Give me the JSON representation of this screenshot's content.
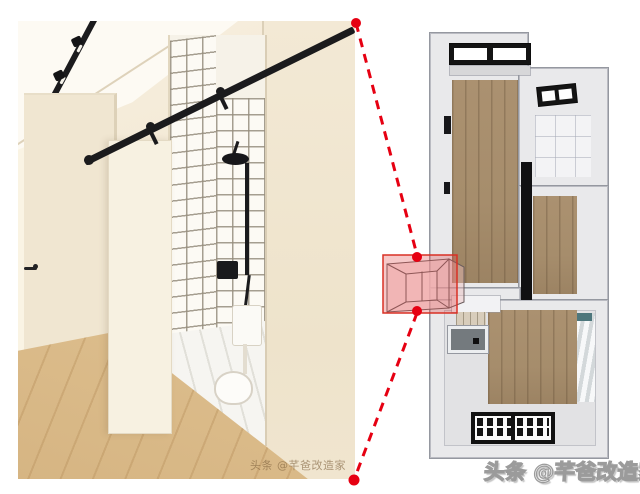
{
  "watermarks": {
    "photo": "头条 @芊爸改造家",
    "brand": "头条 @芊爸改造家"
  },
  "icons": {
    "callout_dot": "filled-red-circle",
    "callout_connector": "red-dashed-line",
    "highlight_box": "translucent-red-rectangle-with-3d-room-sketch"
  },
  "colors": {
    "accent_red": "#e60012",
    "highlight_fill": "rgba(226,74,74,0.30)",
    "highlight_border": "#d93025",
    "photo_wall": "#f2e7d2",
    "photo_wall_light": "#faf4e4",
    "photo_wood": "#ddbe8d",
    "fixture_black": "#1b1b1d",
    "plan_wall": "#e9e9eb",
    "plan_edge": "#9598a0",
    "plan_wood": "#a68d6c",
    "plan_tile": "#f3f3f5",
    "plan_dark_floor": "#747a7e",
    "curtain_teal": "#4d767c",
    "watermark_photo_color": "rgba(128,98,62,0.62)",
    "watermark_brand_fill": "#ededed",
    "watermark_brand_outline": "#9b9b9b"
  }
}
